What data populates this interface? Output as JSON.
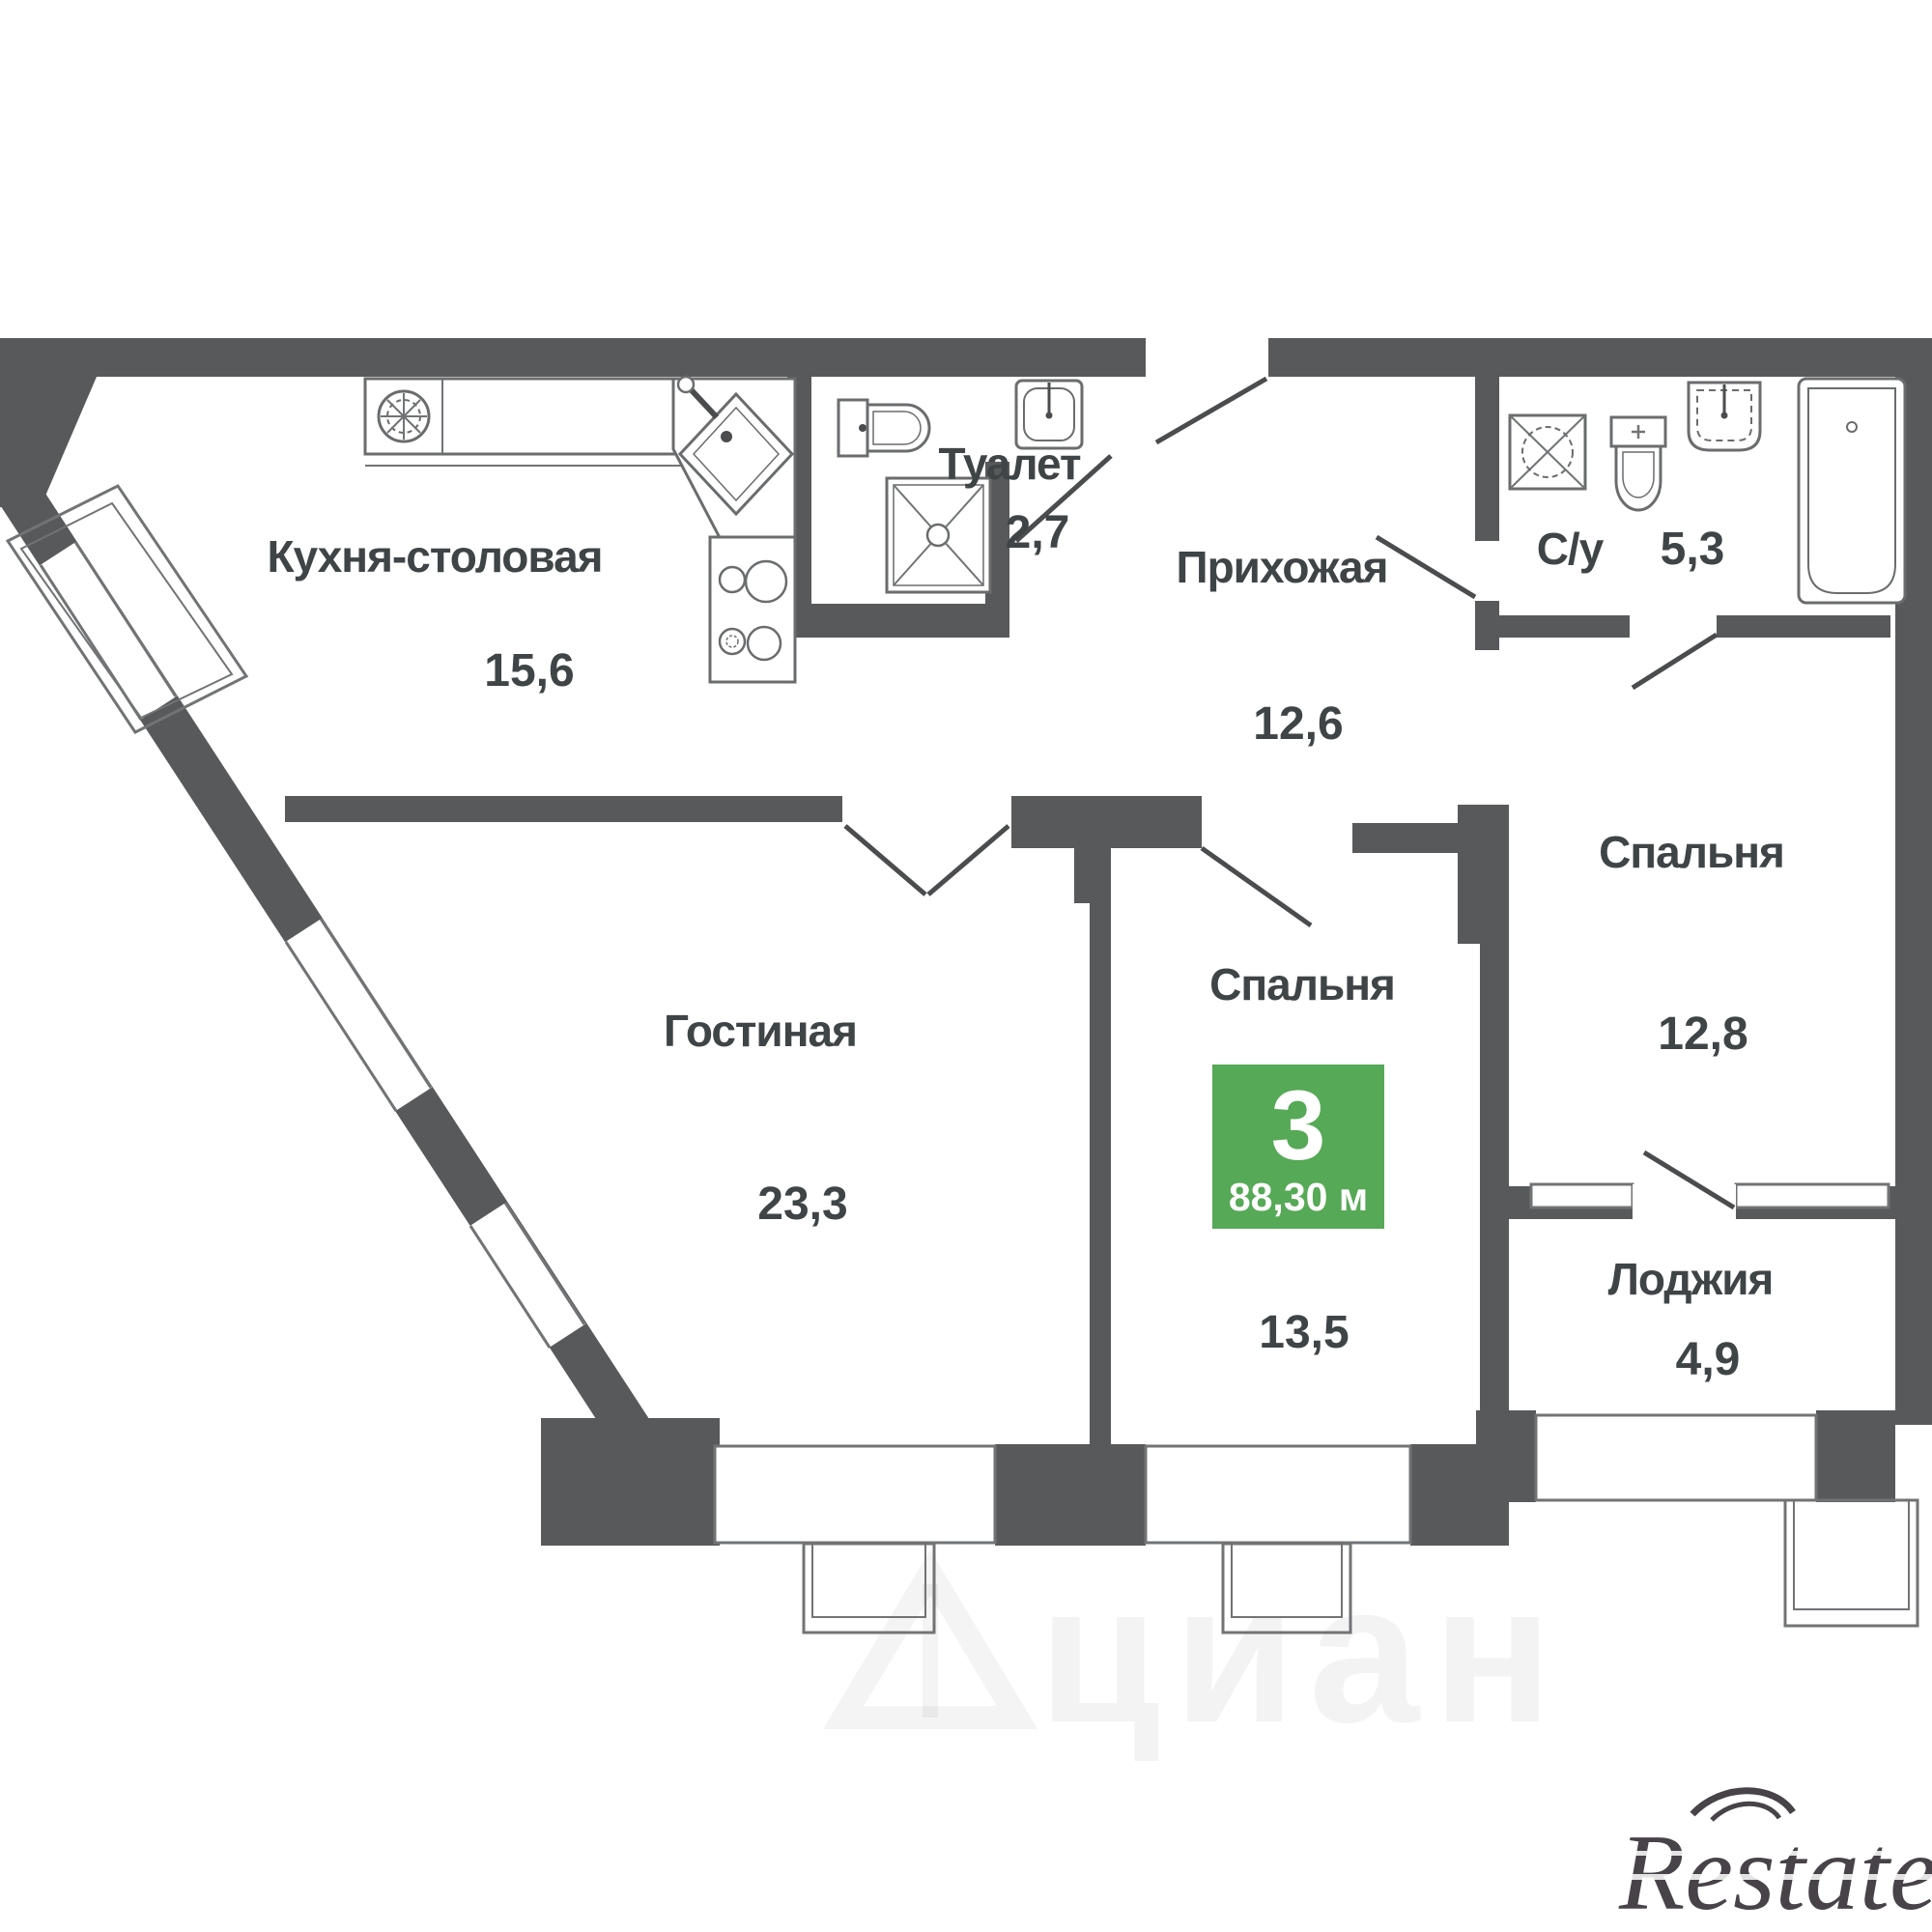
{
  "plan": {
    "badge": {
      "rooms_count": "3",
      "total_area": "88,30 м",
      "color": "#56a956"
    },
    "rooms": {
      "kitchen": {
        "label": "Кухня-столовая",
        "area": "15,6"
      },
      "toilet": {
        "label": "Туалет",
        "area": "2,7"
      },
      "hallway": {
        "label": "Прихожая",
        "area": "12,6"
      },
      "bathroom": {
        "label": "С/у",
        "area": "5,3"
      },
      "bedroom_right": {
        "label": "Спальня",
        "area": "12,8"
      },
      "living_room": {
        "label": "Гостиная",
        "area": "23,3"
      },
      "bedroom_center": {
        "label": "Спальня",
        "area": "13,5"
      },
      "loggia": {
        "label": "Лоджия",
        "area": "4,9"
      }
    },
    "watermarks": {
      "cian": "циан",
      "restate": "Restate"
    },
    "colors": {
      "wall": "#58595b",
      "thin_line": "#717375",
      "text": "#3f4447",
      "badge_green": "#56a956"
    }
  }
}
